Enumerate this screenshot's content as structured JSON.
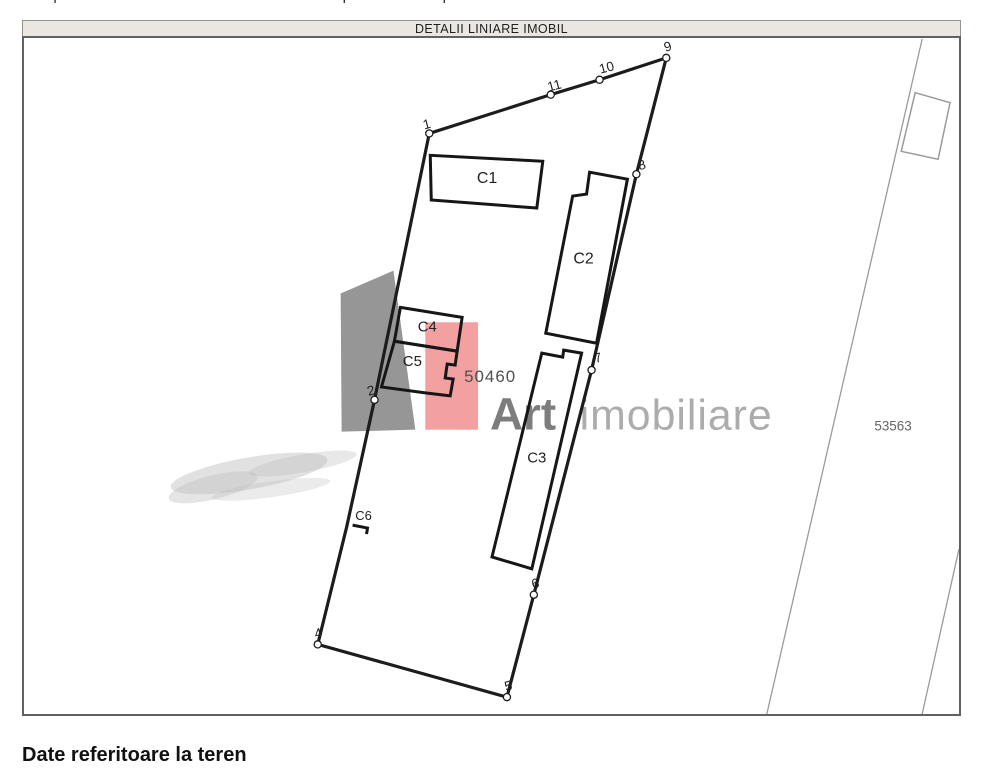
{
  "page": {
    "top_clipped_text": "Suprafetele sunt determinate in planul de proiectie Stereo 70.",
    "header_title": "DETALII LINIARE IMOBIL",
    "footer_title": "Date referitoare la teren"
  },
  "plan": {
    "parcel_label": {
      "text": "50460",
      "pos": [
        464,
        382
      ]
    },
    "neighbor_label": {
      "text": "53563",
      "pos": [
        876,
        431
      ]
    },
    "boundary": [
      [
        429,
        132
      ],
      [
        551,
        93
      ],
      [
        600,
        78
      ],
      [
        667,
        56
      ],
      [
        637,
        173
      ],
      [
        592,
        370
      ],
      [
        534,
        596
      ],
      [
        507,
        699
      ],
      [
        317,
        646
      ],
      [
        346,
        528
      ],
      [
        374,
        400
      ]
    ],
    "buildings": [
      {
        "label": "C1",
        "size": 16,
        "closed": true,
        "path": [
          [
            430,
            154
          ],
          [
            543,
            160
          ],
          [
            537,
            207
          ],
          [
            431,
            199
          ]
        ],
        "label_pos": [
          487,
          182
        ]
      },
      {
        "label": "C2",
        "size": 16,
        "closed": true,
        "path": [
          [
            590,
            171
          ],
          [
            628,
            178
          ],
          [
            597,
            343
          ],
          [
            546,
            333
          ],
          [
            573,
            195
          ],
          [
            587,
            193
          ]
        ],
        "label_pos": [
          584,
          263
        ]
      },
      {
        "label": "C3",
        "size": 15,
        "closed": true,
        "path": [
          [
            542,
            353
          ],
          [
            563,
            357
          ],
          [
            564,
            350
          ],
          [
            582,
            353
          ],
          [
            532,
            570
          ],
          [
            492,
            558
          ]
        ],
        "label_pos": [
          537,
          463
        ]
      },
      {
        "label": "C4",
        "size": 15,
        "closed": true,
        "path": [
          [
            400,
            307
          ],
          [
            462,
            317
          ],
          [
            457,
            351
          ],
          [
            394,
            341
          ]
        ],
        "label_pos": [
          427,
          331
        ]
      },
      {
        "label": "C5",
        "size": 15,
        "closed": true,
        "path": [
          [
            394,
            341
          ],
          [
            457,
            351
          ],
          [
            455,
            365
          ],
          [
            447,
            364
          ],
          [
            445,
            378
          ],
          [
            453,
            379
          ],
          [
            450,
            396
          ],
          [
            425,
            393
          ],
          [
            381,
            387
          ]
        ],
        "label_pos": [
          412,
          366
        ]
      },
      {
        "label": "C6",
        "size": 13,
        "closed": false,
        "path": [
          [
            352,
            526
          ],
          [
            367,
            529
          ],
          [
            366,
            535
          ]
        ],
        "label_pos": [
          363,
          521
        ]
      }
    ],
    "points": [
      {
        "n": "1",
        "marker": [
          429,
          132
        ],
        "label": [
          424,
          128
        ]
      },
      {
        "n": "2",
        "marker": [
          374,
          400
        ],
        "label": [
          368,
          396
        ]
      },
      {
        "n": "4",
        "marker": [
          317,
          646
        ],
        "label": [
          315,
          640
        ]
      },
      {
        "n": "5",
        "marker": [
          507,
          699
        ],
        "label": [
          506,
          693
        ]
      },
      {
        "n": "6",
        "marker": [
          534,
          596
        ],
        "label": [
          533,
          590
        ]
      },
      {
        "n": "7",
        "marker": [
          592,
          370
        ],
        "label": [
          596,
          363
        ]
      },
      {
        "n": "8",
        "marker": [
          637,
          173
        ],
        "label": [
          640,
          169
        ]
      },
      {
        "n": "9",
        "marker": [
          667,
          56
        ],
        "label": [
          666,
          50
        ]
      },
      {
        "n": "10",
        "marker": [
          600,
          78
        ],
        "label": [
          601,
          72
        ]
      },
      {
        "n": "11",
        "marker": [
          551,
          93
        ],
        "label": [
          549,
          90
        ]
      }
    ],
    "neighbor": {
      "line_a": [
        [
          924,
          37
        ],
        [
          768,
          716
        ]
      ],
      "line_b": [
        [
          961,
          550
        ],
        [
          924,
          716
        ]
      ],
      "building": [
        [
          917,
          91
        ],
        [
          952,
          101
        ],
        [
          940,
          158
        ],
        [
          903,
          150
        ]
      ]
    },
    "watermark": {
      "word_bold": "Art",
      "word_light": "imobiliare",
      "gray_quad": [
        [
          340,
          293
        ],
        [
          393,
          270
        ],
        [
          415,
          430
        ],
        [
          341,
          432
        ]
      ],
      "red_rect": [
        425,
        322,
        53,
        108
      ],
      "smudge_blobs": [
        [
          248,
          474,
          80,
          16,
          -10,
          0.45
        ],
        [
          302,
          464,
          55,
          9,
          -10,
          0.35
        ],
        [
          212,
          488,
          46,
          12,
          -14,
          0.4
        ],
        [
          270,
          490,
          60,
          8,
          -8,
          0.3
        ]
      ],
      "text_pos": {
        "art": [
          490,
          430
        ],
        "imobiliare": [
          580,
          430
        ]
      }
    },
    "colors": {
      "boundary": "#1c1c1c",
      "building": "#161616",
      "thin_line": "#9a9a9a",
      "label": "#222222",
      "parcel_label": "#4f4f4f",
      "neighbor_label": "#666666",
      "watermark_gray": "#969696",
      "watermark_red": "#f2a0a0",
      "art_text": "#7d7d7d",
      "imobiliare_text": "#acacac",
      "smudge": "#bdbdbd"
    }
  }
}
